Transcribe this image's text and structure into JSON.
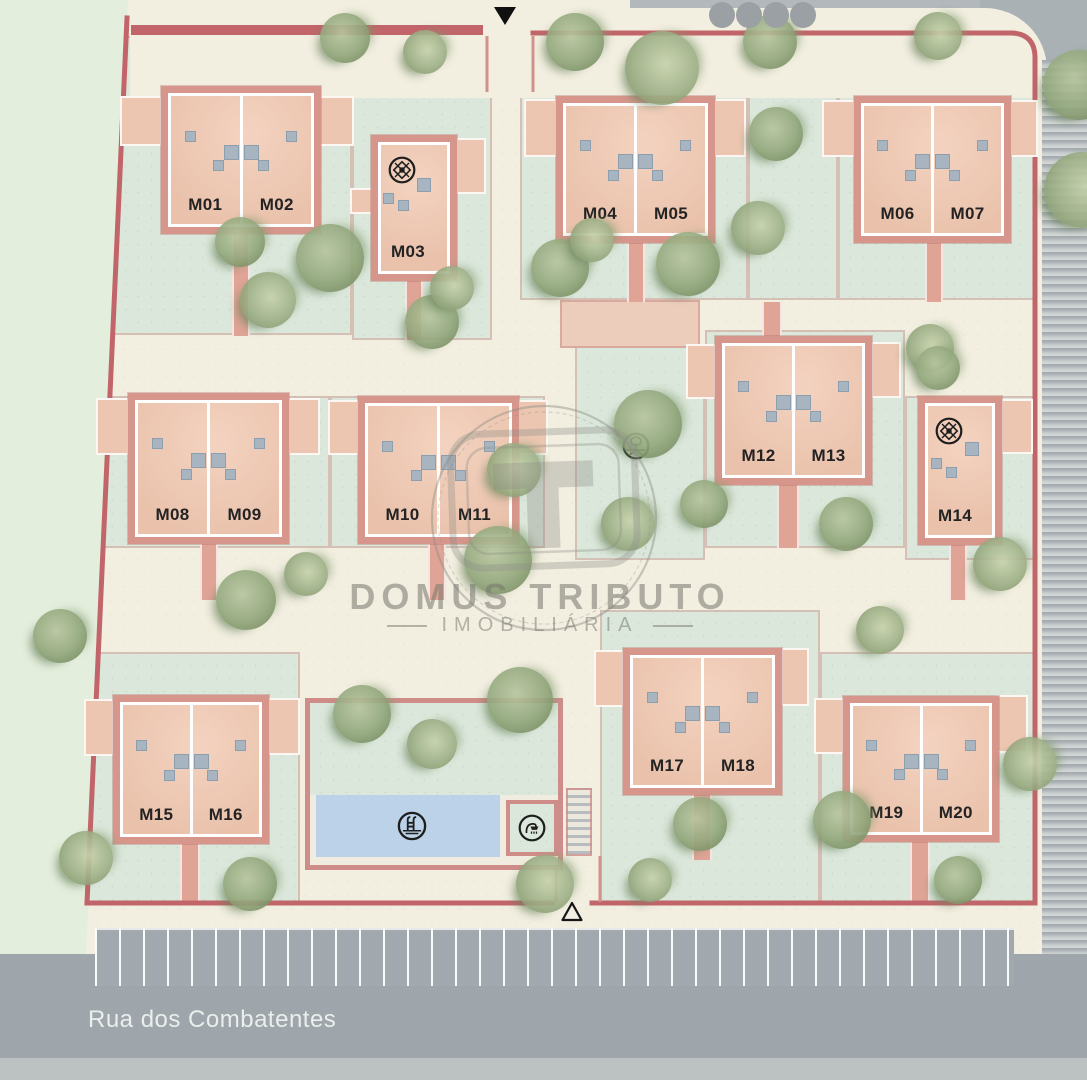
{
  "plan": {
    "street_label": "Rua dos Combatentes",
    "watermark": {
      "brand": "DOMUS TRIBUTO",
      "tagline": "IMOBILIÁRIA"
    },
    "units": [
      "M01",
      "M02",
      "M03",
      "M04",
      "M05",
      "M06",
      "M07",
      "M08",
      "M09",
      "M10",
      "M11",
      "M12",
      "M13",
      "M14",
      "M15",
      "M16",
      "M17",
      "M18",
      "M19",
      "M20"
    ],
    "icons": [
      "gazebo-icon",
      "gazebo-icon",
      "playground-tree-icon",
      "pool-ladder-icon",
      "shower-icon"
    ],
    "markers": {
      "top_entrance": "▼",
      "bottom_entrance": "△",
      "gray_dots_top_right": 4
    },
    "colors": {
      "building": "#edc7b2",
      "building_pad": "#d6968b",
      "boundary": "#c2656a",
      "lawn": "#dbe7db",
      "ground": "#f2eee0",
      "road": "#9ea6ab",
      "pool": "#bcd2e8",
      "roof_vent": "#a8b5c1"
    }
  }
}
